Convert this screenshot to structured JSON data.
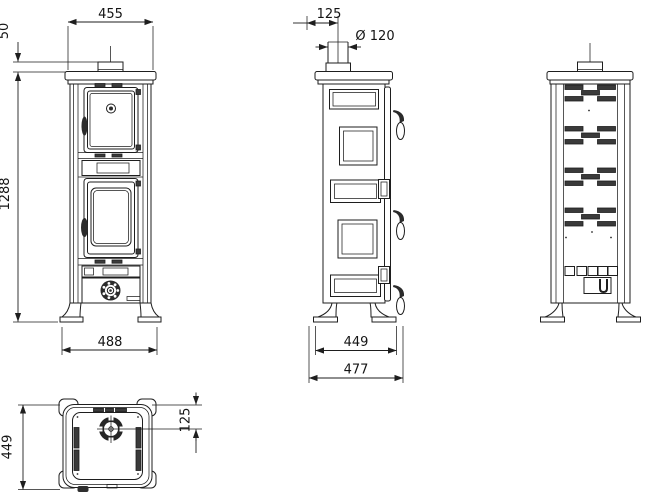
{
  "dimensions": {
    "front_top_width": "455",
    "front_flue_collar_height": "50",
    "front_overall_height": "1288",
    "front_base_width": "488",
    "side_flue_offset": "125",
    "side_flue_diameter": "Ø 120",
    "side_body_depth": "449",
    "side_overall_depth": "477",
    "top_depth": "449",
    "top_flue_center_offset": "125"
  },
  "colors": {
    "line": "#1e1e1e",
    "dark_fill": "#3a3a3a",
    "background": "#ffffff"
  }
}
